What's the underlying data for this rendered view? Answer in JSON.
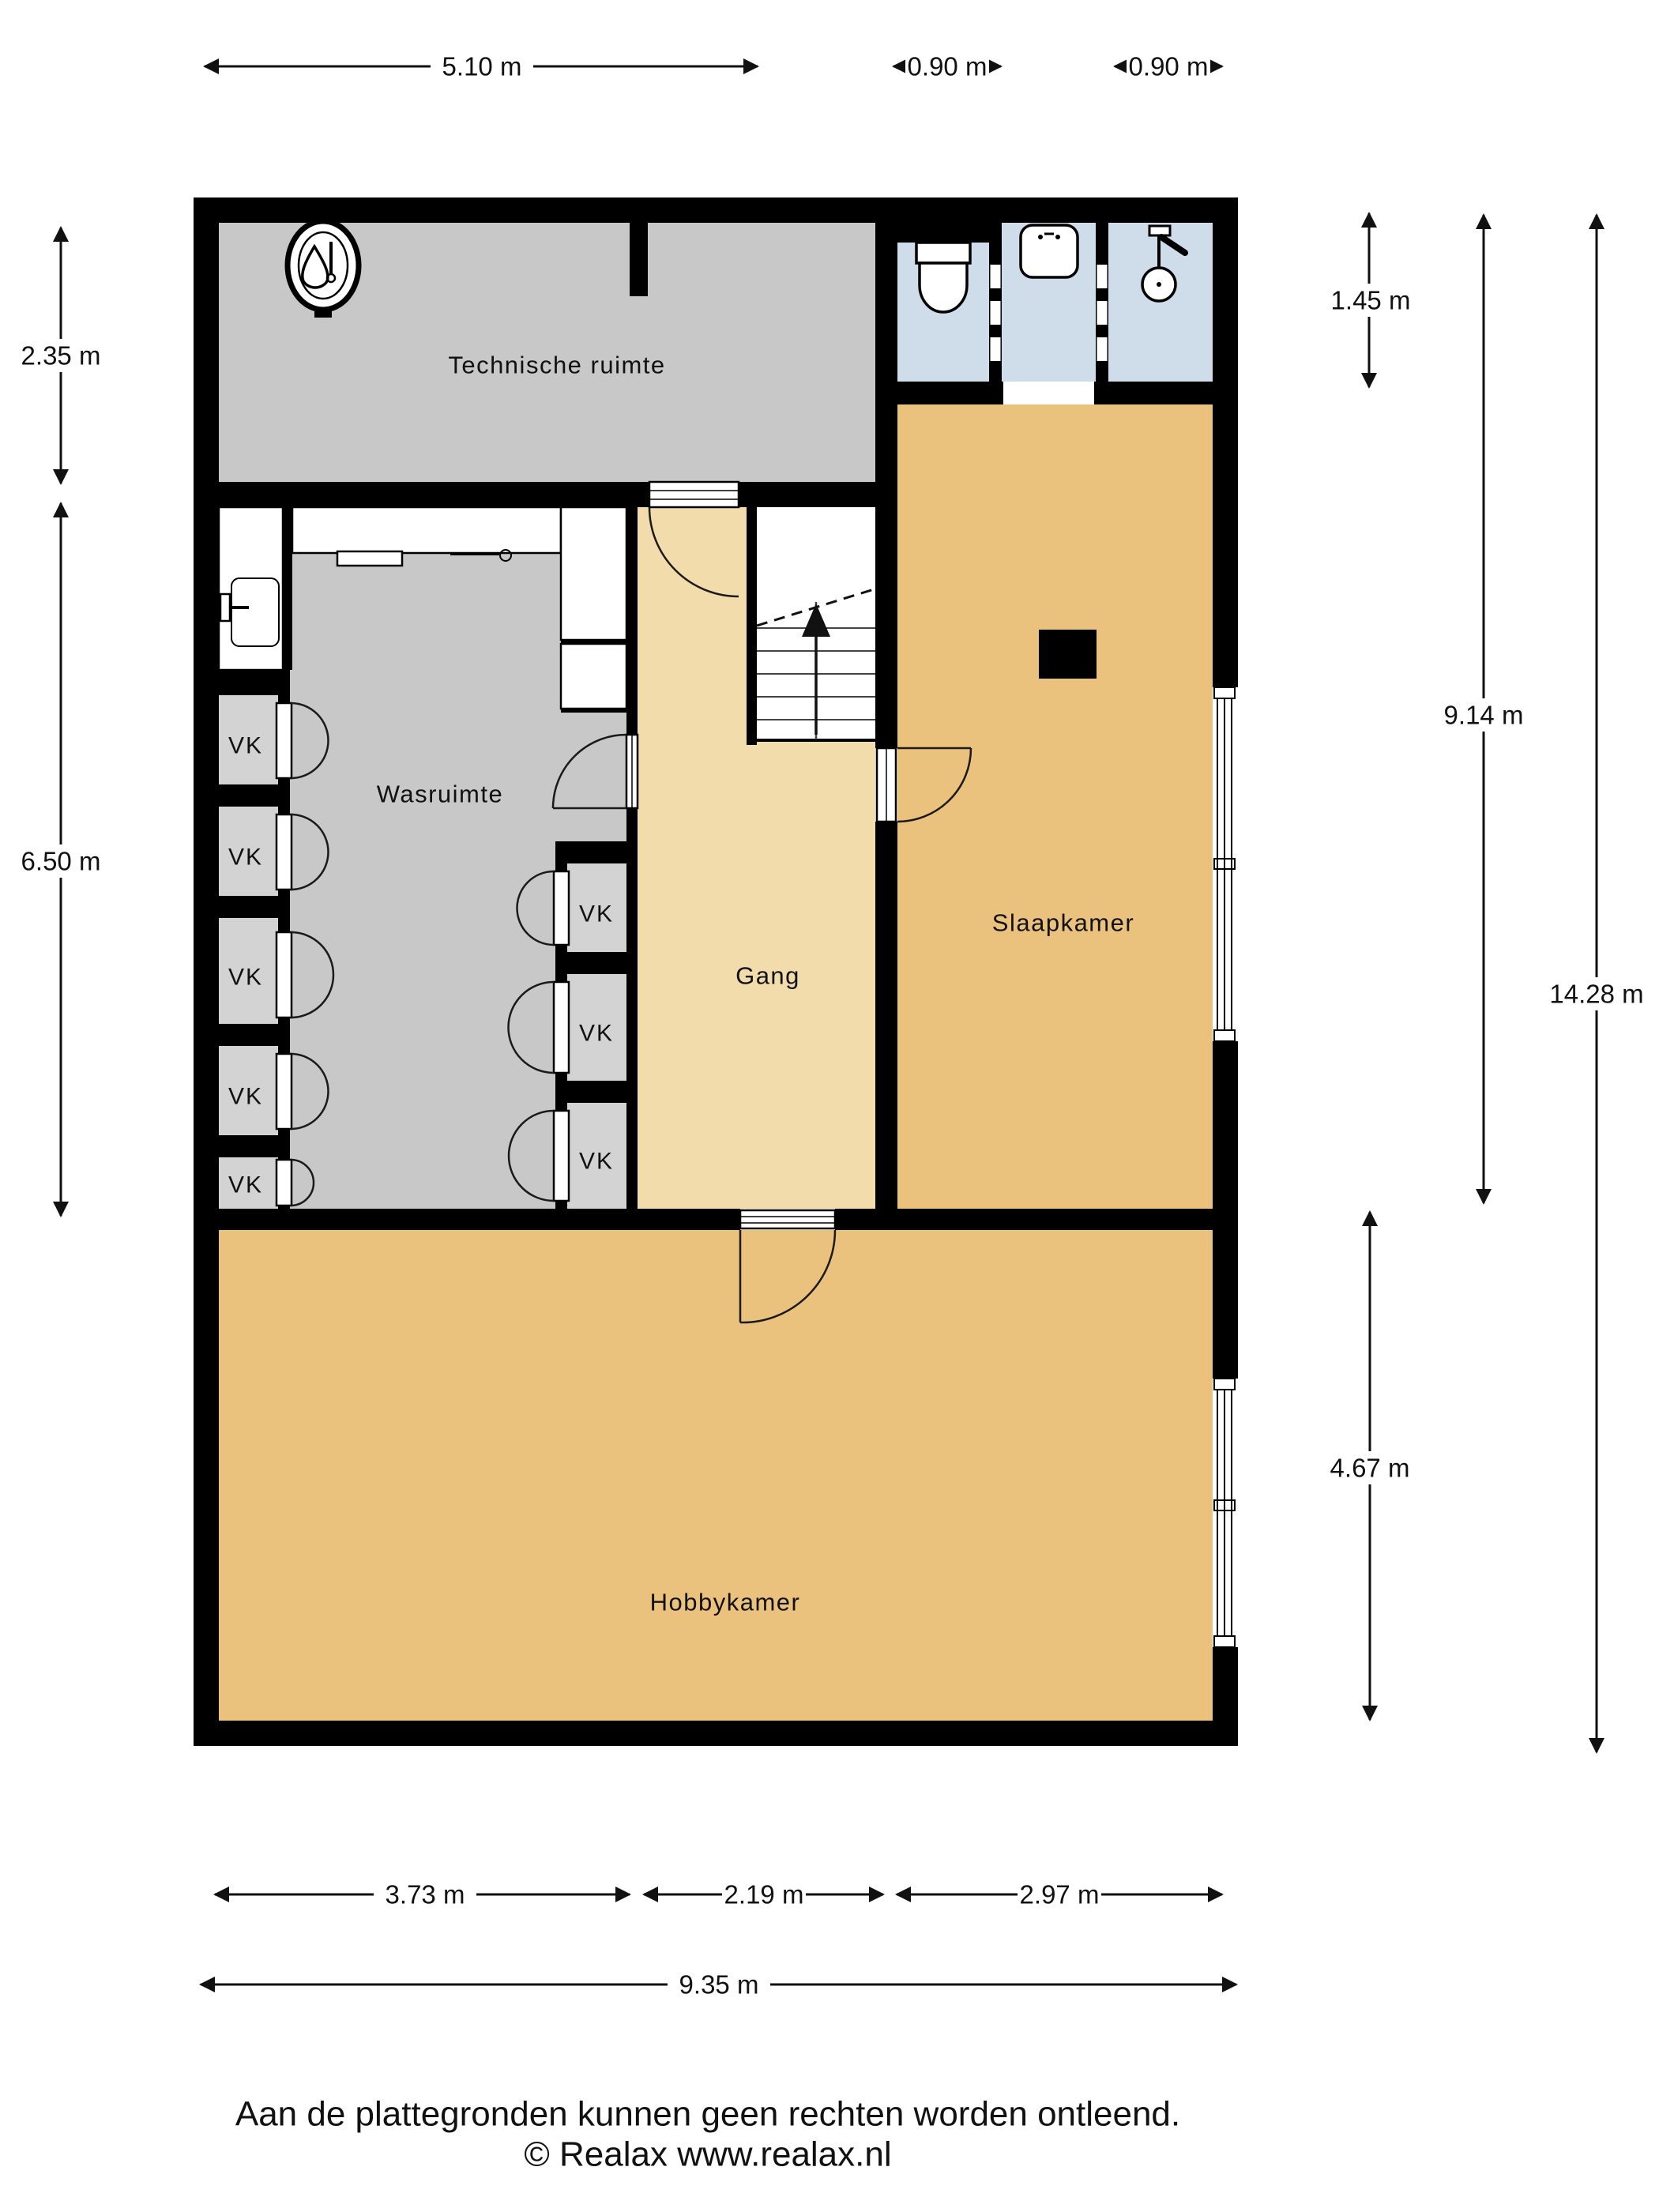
{
  "plan": {
    "rooms": {
      "technische_ruimte": {
        "label": "Technische ruimte"
      },
      "wasruimte": {
        "label": "Wasruimte"
      },
      "gang": {
        "label": "Gang"
      },
      "slaapkamer": {
        "label": "Slaapkamer"
      },
      "hobbykamer": {
        "label": "Hobbykamer"
      }
    },
    "closet_label": "VK",
    "colors": {
      "wall": "#000000",
      "room_gray": "#c8c8c8",
      "closet_gray": "#d3d3d3",
      "bathroom_blue": "#cfdcea",
      "room_tan": "#eac27e",
      "hall_tan": "#f3dcab"
    }
  },
  "dimensions": {
    "top": [
      {
        "label": "5.10 m"
      },
      {
        "label": "0.90 m"
      },
      {
        "label": "0.90 m"
      }
    ],
    "left": [
      {
        "label": "2.35 m"
      },
      {
        "label": "6.50 m"
      }
    ],
    "right": [
      {
        "label": "1.45 m"
      },
      {
        "label": "9.14 m"
      },
      {
        "label": "14.28 m"
      },
      {
        "label": "4.67 m"
      }
    ],
    "bottom": [
      {
        "label": "3.73 m"
      },
      {
        "label": "2.19 m"
      },
      {
        "label": "2.97 m"
      },
      {
        "label": "9.35 m"
      }
    ]
  },
  "footer": {
    "disclaimer": "Aan de plattegronden kunnen geen rechten worden ontleend.",
    "copyright": "© Realax www.realax.nl"
  }
}
